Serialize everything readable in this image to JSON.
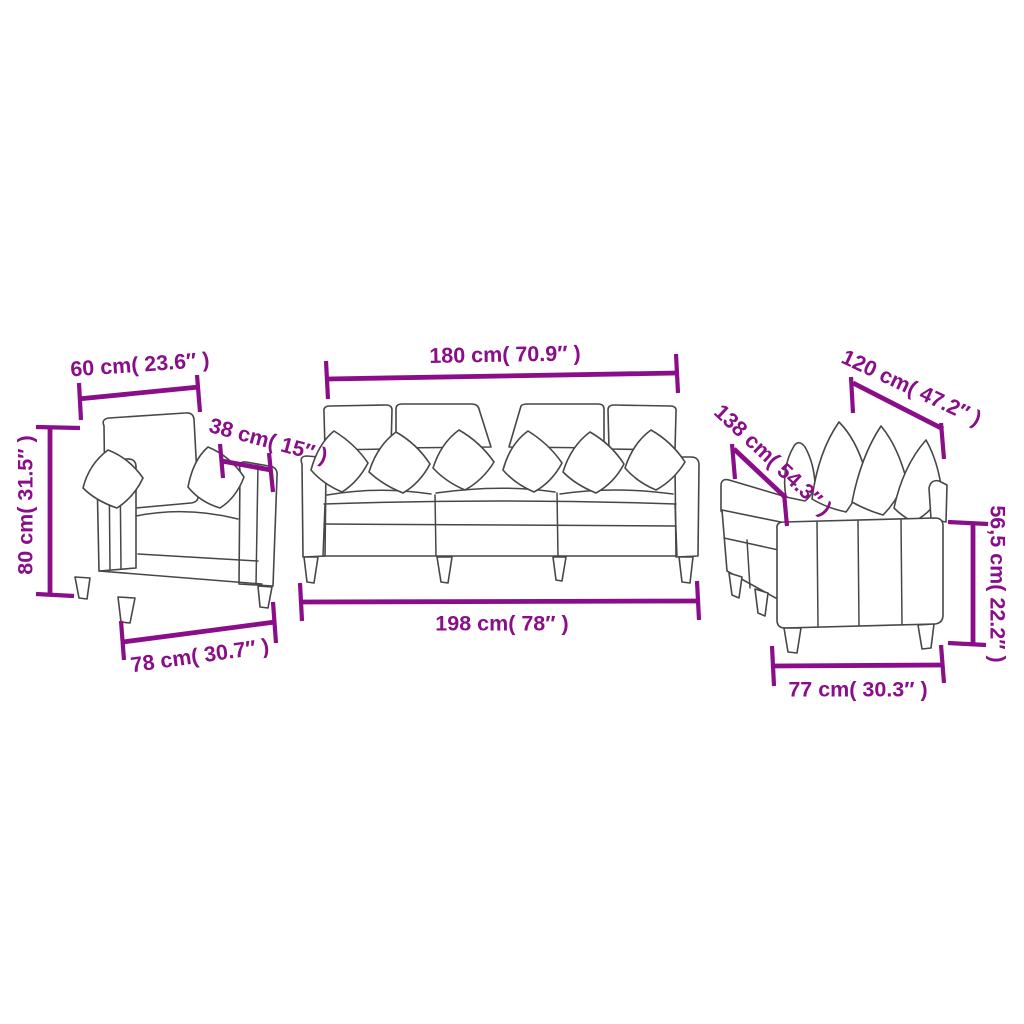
{
  "colors": {
    "dimension": "#8a0d8a",
    "outline": "#474747",
    "background": "#ffffff"
  },
  "armchair": {
    "dim_top_width": "60 cm( 23.6″ )",
    "dim_seat_depth": "38 cm( 15″ )",
    "dim_height": "80 cm( 31.5″ )",
    "dim_bottom_width": "78 cm( 30.7″ )"
  },
  "three_seater": {
    "dim_top_width": "180 cm( 70.9″ )",
    "dim_bottom_width": "198 cm( 78″ )"
  },
  "two_seater": {
    "dim_top_depth": "120 cm( 47.2″ )",
    "dim_diagonal_length": "138 cm( 54.3″ )",
    "dim_arm_height": "56,5 cm( 22.2″ )",
    "dim_bottom_width": "77 cm( 30.3″ )"
  }
}
